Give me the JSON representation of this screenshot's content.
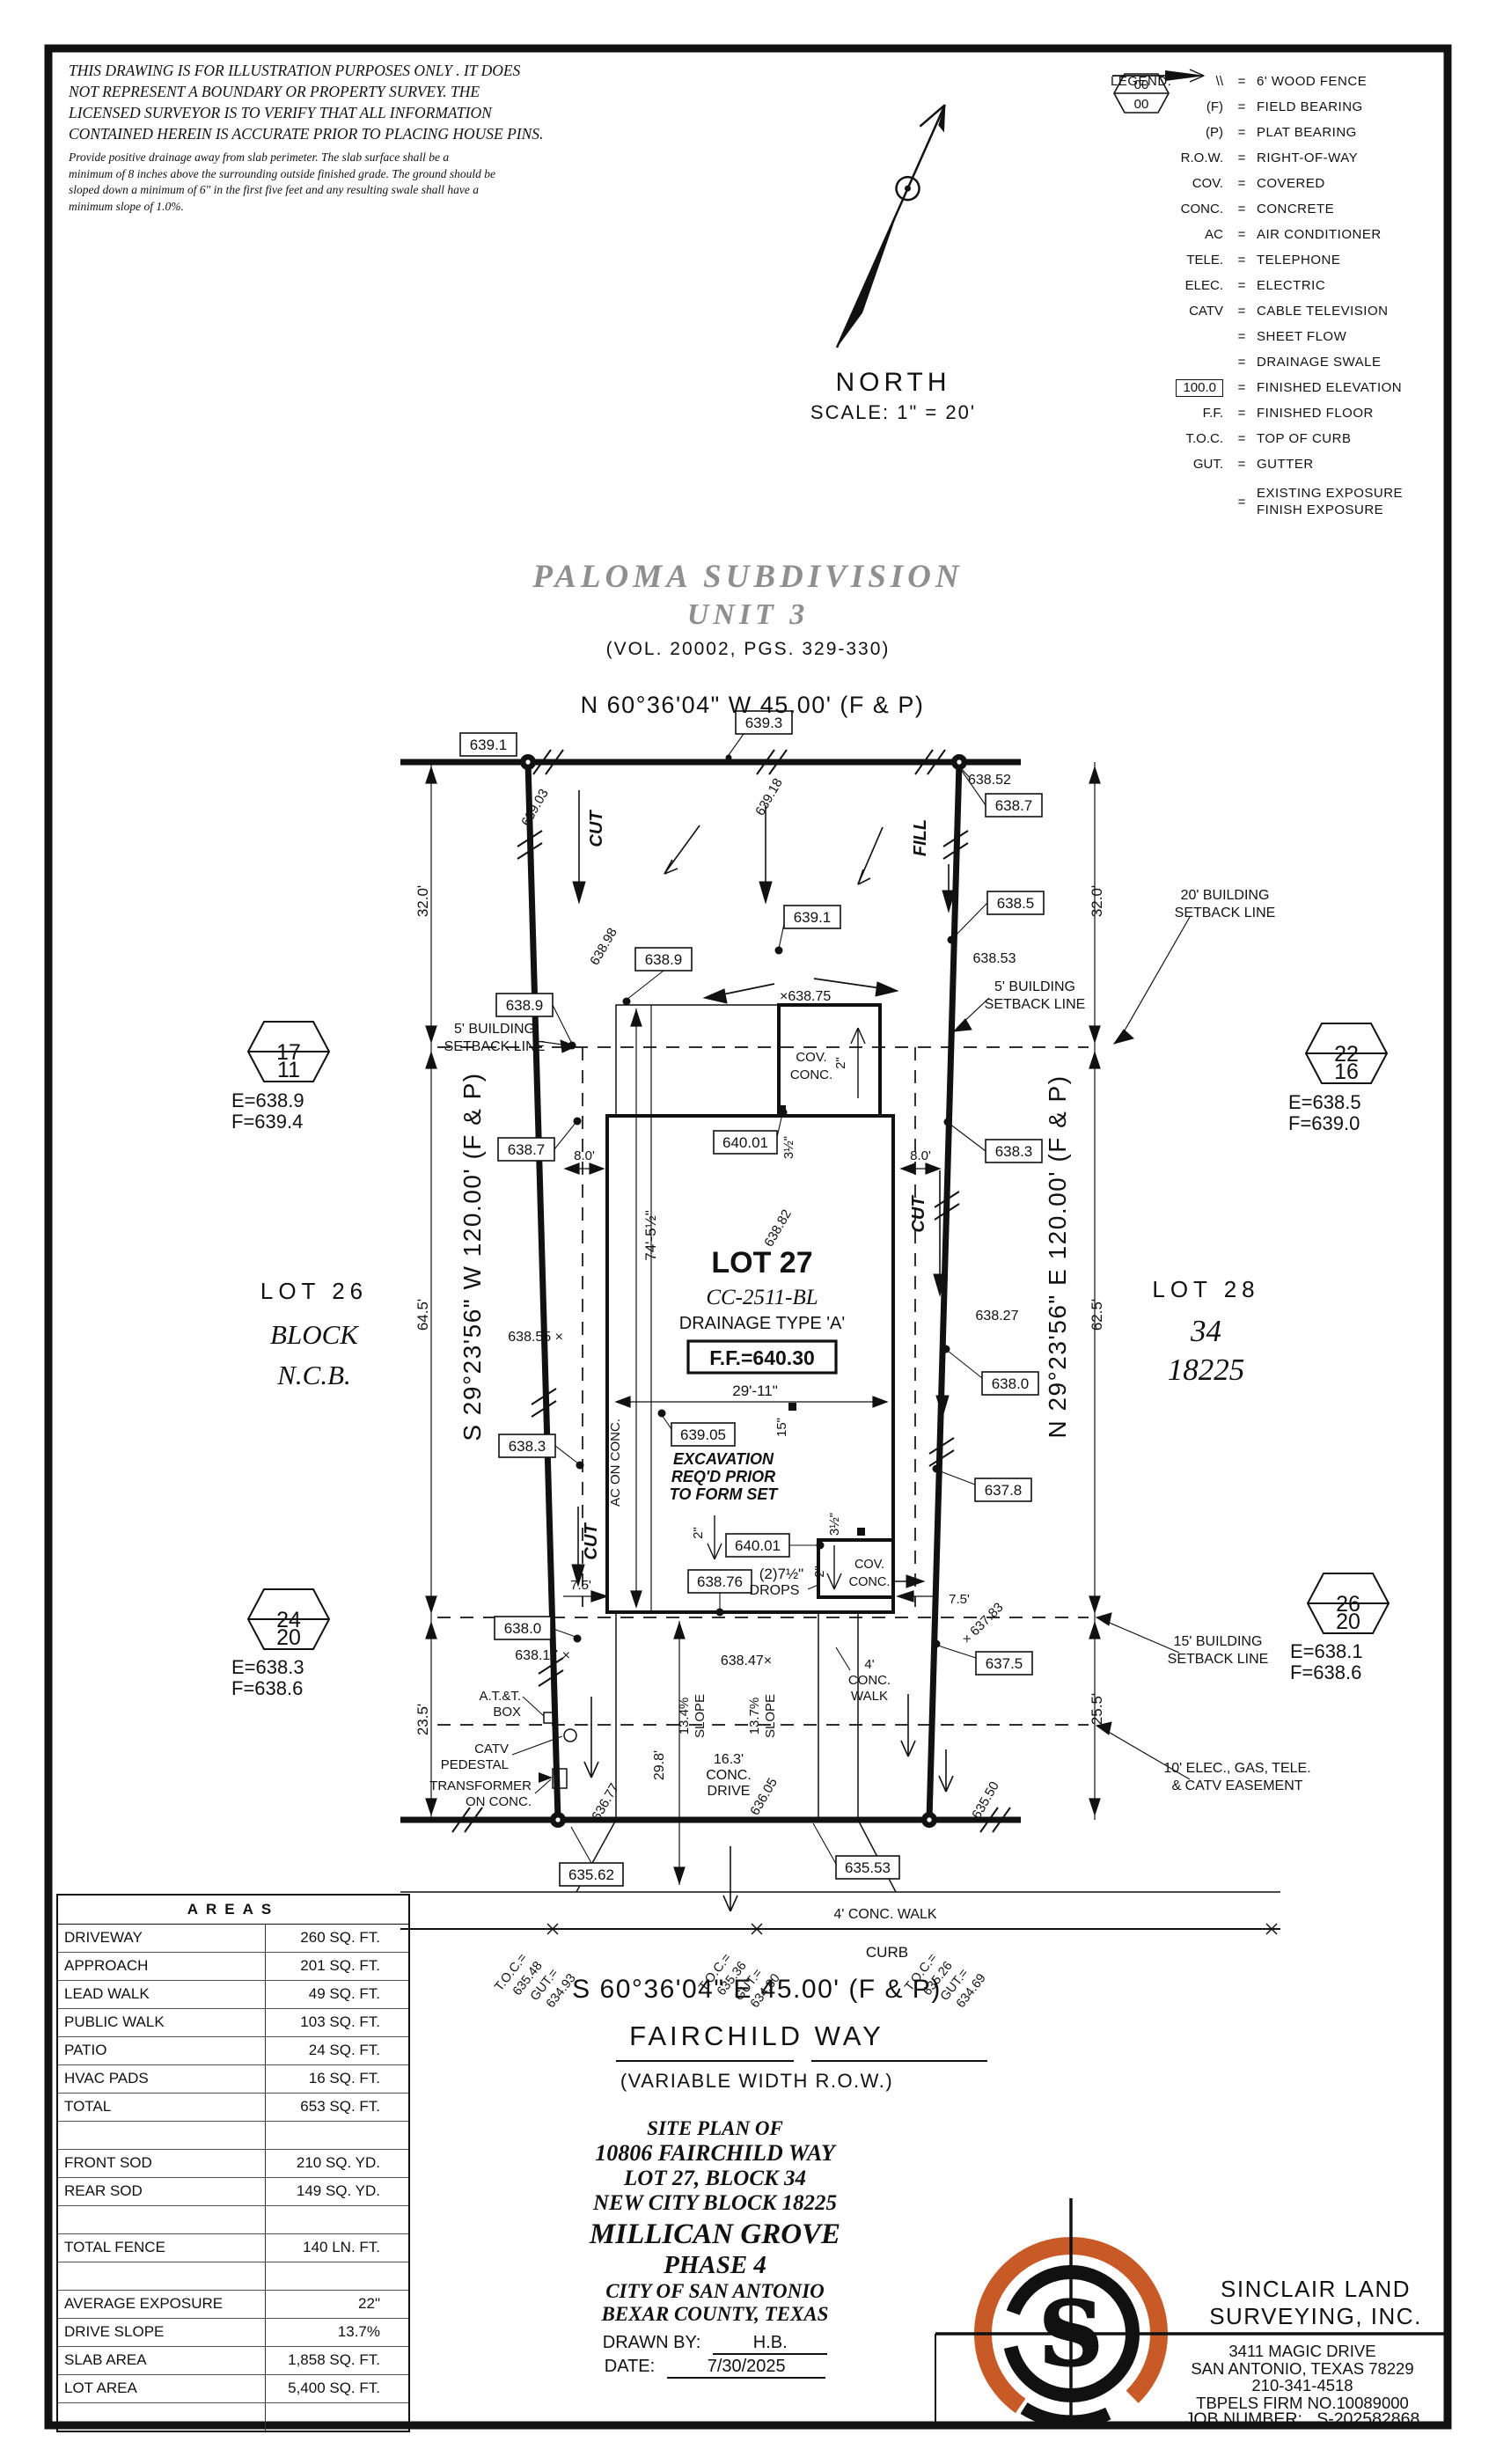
{
  "colors": {
    "ink": "#111111",
    "gray_title": "#8f8f8f",
    "logo_orange": "#c85a28"
  },
  "disclaimer": {
    "l1": "THIS DRAWING IS FOR ILLUSTRATION PURPOSES ONLY . IT DOES",
    "l2": "NOT REPRESENT A BOUNDARY OR PROPERTY SURVEY. THE",
    "l3": "LICENSED SURVEYOR IS TO VERIFY THAT ALL INFORMATION",
    "l4": "CONTAINED HEREIN IS ACCURATE PRIOR TO PLACING HOUSE PINS.",
    "s1": "Provide positive drainage away from slab perimeter. The slab surface shall be a",
    "s2": "minimum of 8 inches above the surrounding outside finished grade. The ground should be",
    "s3": "sloped down a minimum of 6\" in the first five feet and any resulting swale shall have a",
    "s4": "minimum slope of 1.0%."
  },
  "legend": {
    "title": "LEGEND:",
    "eq": "=",
    "hex_top": "00",
    "hex_bottom": "00",
    "items": [
      {
        "sym": "\\\\",
        "label": "6' WOOD FENCE"
      },
      {
        "sym": "(F)",
        "label": "FIELD BEARING"
      },
      {
        "sym": "(P)",
        "label": "PLAT BEARING"
      },
      {
        "sym": "R.O.W.",
        "label": "RIGHT-OF-WAY"
      },
      {
        "sym": "COV.",
        "label": "COVERED"
      },
      {
        "sym": "CONC.",
        "label": "CONCRETE"
      },
      {
        "sym": "AC",
        "label": "AIR CONDITIONER"
      },
      {
        "sym": "TELE.",
        "label": "TELEPHONE"
      },
      {
        "sym": "ELEC.",
        "label": "ELECTRIC"
      },
      {
        "sym": "CATV",
        "label": "CABLE TELEVISION"
      },
      {
        "sym": "",
        "label": "SHEET FLOW"
      },
      {
        "sym": "",
        "label": "DRAINAGE SWALE"
      },
      {
        "sym": "100.0",
        "label": "FINISHED ELEVATION"
      },
      {
        "sym": "F.F.",
        "label": "FINISHED FLOOR"
      },
      {
        "sym": "T.O.C.",
        "label": "TOP OF CURB"
      },
      {
        "sym": "GUT.",
        "label": "GUTTER"
      },
      {
        "label1": "EXISTING EXPOSURE",
        "label2": "FINISH EXPOSURE"
      }
    ]
  },
  "north": {
    "label": "NORTH",
    "scale": "SCALE: 1\" = 20'"
  },
  "subdivision": {
    "name": "PALOMA SUBDIVISION",
    "unit": "UNIT 3",
    "vol": "(VOL. 20002, PGS. 329-330)"
  },
  "bearings": {
    "top": "N 60°36'04\" W 45.00' (F & P)",
    "bottom": "S 60°36'04\" E 45.00' (F & P)",
    "left": "S 29°23'56\" W 120.00' (F & P)",
    "right": "N 29°23'56\" E 120.00' (F & P)"
  },
  "street": {
    "name": "FAIRCHILD WAY",
    "row": "(VARIABLE WIDTH R.O.W.)"
  },
  "adjacent": {
    "lot26": "LOT 26",
    "block": "BLOCK",
    "ncb": "N.C.B.",
    "lot28": "LOT 28",
    "block34": "34",
    "ncb18225": "18225"
  },
  "exposures": {
    "h1t": "17",
    "h1b": "11",
    "h1e": "E=638.9",
    "h1f": "F=639.4",
    "h2t": "22",
    "h2b": "16",
    "h2e": "E=638.5",
    "h2f": "F=639.0",
    "h3t": "24",
    "h3b": "20",
    "h3e": "E=638.3",
    "h3f": "F=638.6",
    "h4t": "26",
    "h4b": "20",
    "h4e": "E=638.1",
    "h4f": "F=638.6"
  },
  "plan": {
    "ev639_1a": "639.1",
    "ev639_3": "639.3",
    "t638_52": "638.52",
    "ev638_7a": "638.7",
    "r639_03": "639.03",
    "r639_18": "639.18",
    "cut_a": "CUT",
    "fill_a": "FILL",
    "ev638_9a": "638.9",
    "ev638_9b": "638.9",
    "r638_98": "638.98",
    "ev639_1b": "639.1",
    "x638_75": "×638.75",
    "ev638_5": "638.5",
    "t638_53": "638.53",
    "sbl5a1": "5' BUILDING",
    "sbl5a2": "SETBACK LINE",
    "sbl5b1": "5' BUILDING",
    "sbl5b2": "SETBACK LINE",
    "sbl20a": "20' BUILDING",
    "sbl20b": "SETBACK LINE",
    "sbl15a": "15' BUILDING",
    "sbl15b": "SETBACK LINE",
    "ease1": "10' ELEC., GAS, TELE.",
    "ease2": "& CATV EASEMENT",
    "dim32a": "32.0'",
    "dim32b": "32.0'",
    "dim64_5": "64.5'",
    "dim62_5": "62.5'",
    "dim23_5": "23.5'",
    "dim25_5": "25.5'",
    "cov1": "COV.",
    "conc1": "CONC.",
    "in2a": "2\"",
    "ev640_01a": "640.01",
    "in3ha": "3½\"",
    "dim8a": "8.0'",
    "dim8b": "8.0'",
    "ev638_7b": "638.7",
    "ev638_3a": "638.3",
    "dim74": "74'-5½\"",
    "lot27": "LOT 27",
    "r638_82": "638.82",
    "cc": "CC-2511-BL",
    "drainage": "DRAINAGE TYPE 'A'",
    "ff": "F.F.=640.30",
    "cut_b": "CUT",
    "cut_c": "CUT",
    "t638_27": "638.27",
    "x638_55": "638.55 ×",
    "ev638_3b": "638.3",
    "ev639_05": "639.05",
    "dim29_11": "29'-11\"",
    "dim15": "15\"",
    "exc1": "EXCAVATION",
    "exc2": "REQ'D PRIOR",
    "exc3": "TO FORM SET",
    "ac": "AC ON CONC.",
    "in2b": "2\"",
    "ev640_01b": "640.01",
    "in3hb": "3½\"",
    "ev638_76": "638.76",
    "drops1": "(2)7½\"",
    "drops2": "DROPS",
    "cov2": "COV.",
    "conc2": "CONC.",
    "in2c": "2\"",
    "dim7_5a": "7.5'",
    "dim7_5b": "7.5'",
    "ev638_0a": "638.0",
    "x638_17": "638.17 ×",
    "ev638_0b": "638.0",
    "ev637_8": "637.8",
    "x637_83": "× 637.83",
    "ev637_5": "637.5",
    "att1": "A.T.&T.",
    "att2": "BOX",
    "catv1": "CATV",
    "catv2": "PEDESTAL",
    "tr1": "TRANSFORMER",
    "tr2": "ON CONC.",
    "t638_47": "638.47×",
    "w4a": "4'",
    "w4b": "CONC.",
    "w4c": "WALK",
    "sl1a": "13.4%",
    "sl1b": "SLOPE",
    "sl2a": "13.7%",
    "sl2b": "SLOPE",
    "dim29_8": "29.8'",
    "dr1": "16.3'",
    "dr2": "CONC.",
    "dr3": "DRIVE",
    "r636_77": "636.77",
    "r636_05": "636.05",
    "r635_50": "635.50",
    "ev635_62": "635.62",
    "ev635_53": "635.53",
    "walk4": "4' CONC. WALK",
    "curb": "CURB",
    "tocl1": "T.O.C.=",
    "tocl2": "635.48",
    "tocl3": "GUT.=",
    "tocl4": "634.93",
    "tocm1": "T.O.C.=",
    "tocm2": "635.36",
    "tocm3": "GUT.=",
    "tocm4": "634.80",
    "tocr1": "T.O.C.=",
    "tocr2": "635.26",
    "tocr3": "GUT.=",
    "tocr4": "634.69"
  },
  "areas": {
    "title": "AREAS",
    "rows": [
      [
        "DRIVEWAY",
        "260 SQ. FT."
      ],
      [
        "APPROACH",
        "201 SQ. FT."
      ],
      [
        "LEAD WALK",
        "49 SQ. FT."
      ],
      [
        "PUBLIC WALK",
        "103 SQ. FT."
      ],
      [
        "PATIO",
        "24 SQ. FT."
      ],
      [
        "HVAC PADS",
        "16 SQ. FT."
      ],
      [
        "TOTAL",
        "653 SQ. FT."
      ],
      [
        "",
        ""
      ],
      [
        "FRONT SOD",
        "210 SQ. YD."
      ],
      [
        "REAR SOD",
        "149 SQ. YD."
      ],
      [
        "",
        ""
      ],
      [
        "TOTAL FENCE",
        "140 LN. FT."
      ],
      [
        "",
        ""
      ],
      [
        "AVERAGE EXPOSURE",
        "22\""
      ],
      [
        "DRIVE SLOPE",
        "13.7%"
      ],
      [
        "SLAB AREA",
        "1,858 SQ. FT."
      ],
      [
        "LOT AREA",
        "5,400 SQ. FT."
      ],
      [
        "",
        ""
      ]
    ]
  },
  "title_block": {
    "l1": "SITE PLAN OF",
    "l2": "10806 FAIRCHILD WAY",
    "l3": "LOT 27, BLOCK 34",
    "l4": "NEW CITY BLOCK 18225",
    "l5": "MILLICAN GROVE",
    "l6": "PHASE 4",
    "l7": "CITY OF SAN ANTONIO",
    "l8": "BEXAR COUNTY, TEXAS",
    "drawn_label": "DRAWN BY:",
    "drawn": "H.B.",
    "date_label": "DATE:",
    "date": "7/30/2025"
  },
  "surveyor": {
    "name1": "SINCLAIR LAND",
    "name2": "SURVEYING, INC.",
    "addr1": "3411 MAGIC DRIVE",
    "addr2": "SAN ANTONIO, TEXAS 78229",
    "phone": "210-341-4518",
    "firm": "TBPELS FIRM NO.10089000",
    "job_label": "JOB NUMBER:",
    "job": "S-202582868"
  }
}
